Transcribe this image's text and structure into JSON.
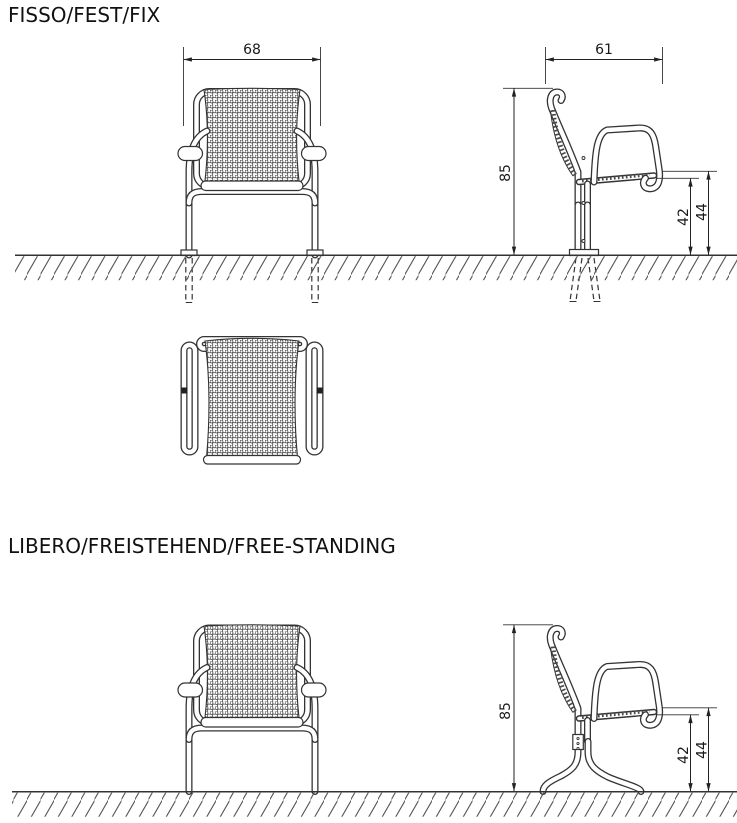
{
  "drawing": {
    "background": "#ffffff",
    "line_color": "#333333",
    "text_color": "#1a1a1a",
    "sections": [
      {
        "title": "FISSO/FEST/FIX",
        "front_view": {
          "overall_width": "68"
        },
        "side_view": {
          "overall_depth": "61",
          "overall_height": "85",
          "seat_underside_height": "42",
          "seat_top_height": "44"
        }
      },
      {
        "title": "LIBERO/FREISTEHEND/FREE-STANDING",
        "side_view": {
          "overall_height": "85",
          "seat_underside_height": "42",
          "seat_top_height": "44"
        }
      }
    ]
  }
}
